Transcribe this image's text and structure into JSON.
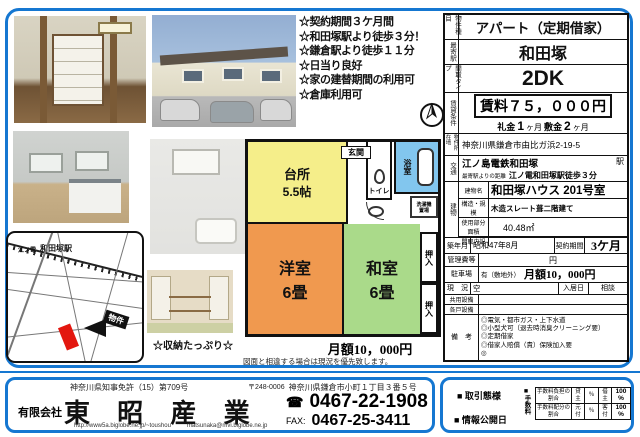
{
  "colors": {
    "frame_blue": "#1577d1",
    "kitchen_yellow": "#f5ee8a",
    "western_orange": "#f0994f",
    "japanese_green": "#aada8a",
    "bath_blue": "#82c6ee",
    "parcel_red": "#e3170f"
  },
  "highlights": {
    "items": [
      "☆契約期間３ケ月間",
      "☆和田塚駅より徒歩３分！",
      "☆鎌倉駅より徒歩１１分",
      "☆日当り良好",
      "☆家の建替期間の利用可",
      "☆倉庫利用可"
    ]
  },
  "photos": {
    "storage_caption": "☆収納たっぷり☆"
  },
  "map": {
    "line_name": "江ノ電",
    "station": "和田塚駅",
    "property_tag": "物件"
  },
  "floorplan": {
    "kitchen_name": "台所",
    "kitchen_size": "5.5帖",
    "entrance": "玄関",
    "toilet": "トイレ",
    "bath": "浴室",
    "laundry_line1": "洗濯機",
    "laundry_line2": "置場",
    "western_name": "洋室",
    "western_size": "6畳",
    "japanese_name": "和室",
    "japanese_size": "6畳",
    "closet1": "押入",
    "closet2": "押入",
    "monthly_fee": "月額10，000円",
    "disclaimer": "図面と相違する場合は現況を優先致します。"
  },
  "details": {
    "type_label": "物件種目",
    "type_value": "アパート（定期借家）",
    "station_label": "最寄駅",
    "station_value": "和田塚",
    "layout_label": "間取タイプ",
    "layout_value": "2DK",
    "terms_label": "賃貸条件",
    "rent": "賃料７５，０００円",
    "key_money_label": "礼金",
    "key_money_value": "1",
    "key_money_unit": "ヶ月",
    "deposit_label": "敷金",
    "deposit_value": "2",
    "deposit_unit": "ヶ月",
    "address_label": "物件所在地",
    "address_value": "神奈川県鎌倉市由比ガ浜2-19-5",
    "access_label": "交通",
    "access_line": "江ノ島電鉄和田塚",
    "access_station_suffix": "駅",
    "distance_label": "最寄駅よりの距離",
    "distance_value": "江ノ電和田塚駅徒歩３分",
    "building_label": "建物",
    "building_name_label": "建物名",
    "building_name_value": "和田塚ハウス 201号室",
    "structure_label": "構造・規模",
    "structure_value": "木造スレート葺二階建て",
    "area_label": "使用部分面積",
    "area_value": "40.48㎡",
    "madori_label": "間取内訳",
    "madori_value": "",
    "built_label": "築年月",
    "built_value": "昭和47年8月",
    "contract_label": "契約期間",
    "contract_value": "3ケ月",
    "mgmt_label": "管理費等",
    "mgmt_value": "円",
    "parking_label": "駐車場",
    "parking_note": "有（敷地外）",
    "parking_fee": "月額10，000円",
    "status_label": "現　況",
    "status_value": "空",
    "movein_label": "入居日",
    "movein_value": "相談",
    "common_equip_label": "共用設備",
    "unit_equip_label": "各戸設備",
    "remarks_label": "備　考",
    "remarks": [
      "◎電気・都市ガス・上下水道",
      "◎小型犬可（退去時消臭クリーニング要）",
      "◎定期借家",
      "◎借家人賠償（責）保険加入要",
      "◎"
    ]
  },
  "footer": {
    "license": "神奈川県知事免許（15）第709号",
    "postal": "〒248-0006",
    "office_address": "神奈川県鎌倉市小町１丁目３番５号",
    "company_prefix": "有限会社",
    "company_name": "東 昭 産 業",
    "url": "http://www5a.biglobe.ne.jp/~toushou",
    "email": "matsunaka@mvi.biglobe.ne.jp",
    "tel_icon": "☎",
    "tel": "0467-22-1908",
    "fax_label": "FAX:",
    "fax": "0467-25-3411",
    "deal_type_label": "■ 取引態様",
    "publish_label": "■ 情報公開日",
    "fee_mark": "■",
    "fee_label": "手数料",
    "fee_rows": [
      {
        "label": "手数料負担の割合",
        "c1": "貸主",
        "v1": "％",
        "c2": "借主",
        "v2": "100 %"
      },
      {
        "label": "手数料配分の割合",
        "c1": "元付",
        "v1": "％",
        "c2": "客付",
        "v2": "100 %"
      }
    ]
  }
}
